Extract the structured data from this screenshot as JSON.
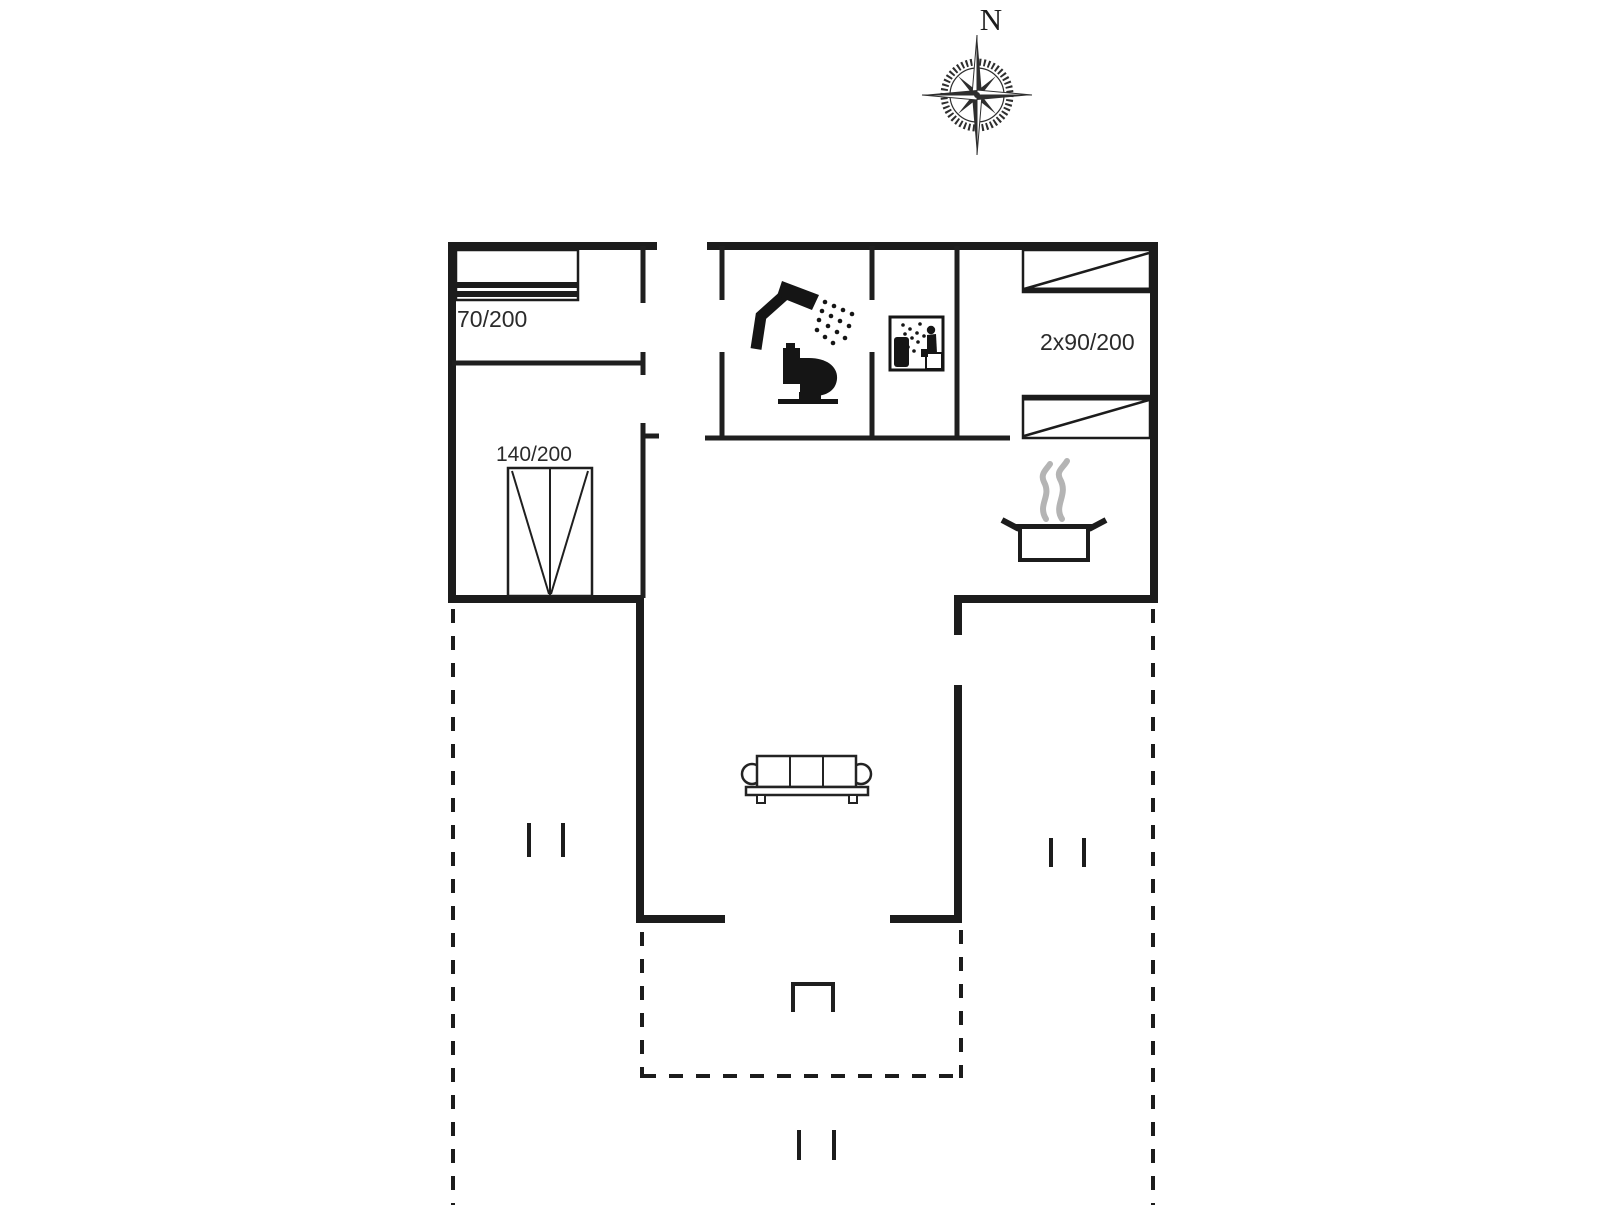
{
  "plan": {
    "title": "holiday-house-floor-plan",
    "compass": {
      "direction_label": "N"
    },
    "rooms": {
      "bedroom_top_left": {
        "bed_label": "70/200"
      },
      "bedroom_bottom_left": {
        "bed_label": "140/200"
      },
      "bedroom_right": {
        "bed_label": "2x90/200"
      }
    },
    "colors": {
      "wall": "#1c1c1c",
      "interior_wall": "#1f1f1f",
      "icon": "#151515",
      "label_text": "#2b2b2b",
      "steam": "#b4b4b4",
      "background": "#ffffff"
    },
    "icons": [
      "compass-rose-icon",
      "single-bed-icon",
      "double-bed-icon",
      "twin-bed-top-icon",
      "twin-bed-bottom-icon",
      "shower-icon",
      "toilet-icon",
      "sauna-icon",
      "cooking-pot-icon",
      "steam-icon",
      "sofa-icon",
      "terrace-step-icon"
    ]
  }
}
